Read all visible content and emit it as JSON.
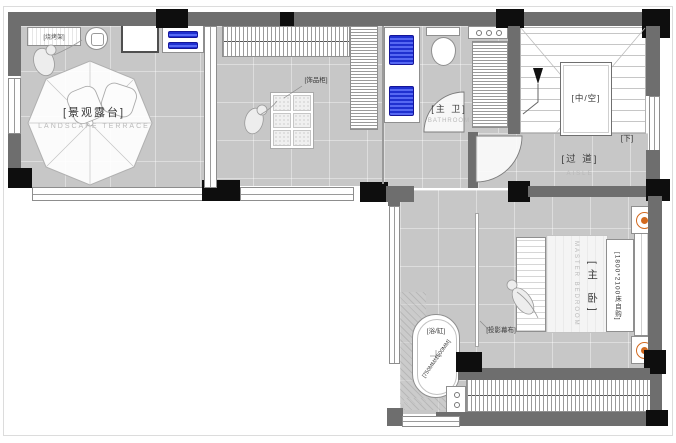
{
  "colors": {
    "floor": "#c7c7c7",
    "wall": "#6e6e6e",
    "column": "#0e0e0e",
    "fixture_border": "#8f8f8f",
    "sink_blue": "#2b3fd8",
    "lamp_orange": "#d2691e",
    "label_text": "#3a3a3a",
    "label_faint": "#b9b9b9"
  },
  "labels": {
    "terrace": {
      "zh": "[景观露台]",
      "en": "LANDSCAPE TERRACE"
    },
    "bbq_rack": {
      "zh": "[烧烤架]"
    },
    "ornament_cabinet": {
      "zh": "[饰品柜]"
    },
    "master_bath": {
      "zh": "[主 卫]",
      "en": "BATHROOM"
    },
    "void": {
      "zh": "[中/空]"
    },
    "stair_down": {
      "zh": "[下]"
    },
    "corridor": {
      "zh": "[过 道]",
      "en": "AISLE"
    },
    "master_bedroom": {
      "zh": "[主 卧]",
      "en": "MASTER BEDROOM",
      "bed_note": "[1800*2100床自购]"
    },
    "projection_screen": {
      "zh": "[投影幕布]"
    },
    "bathtub": {
      "zh": "[浴/缸]",
      "size": "[750MM*1500MM]"
    }
  }
}
